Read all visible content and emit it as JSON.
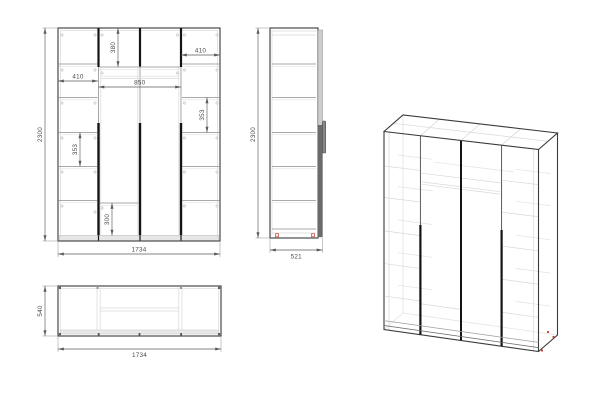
{
  "page": {
    "background": "#ffffff",
    "description": "wardrobe technical drawing with front, side, top and isometric views"
  },
  "colors": {
    "outline": "#3a3a3a",
    "inner_light": "#d8d8d8",
    "inner_mid": "#a9a9a9",
    "divider_dark": "#141414",
    "door_gray": "#6b6b6b",
    "plinth_fill": "#e6e6e6",
    "dimension_line": "#5a5a5a",
    "dimension_text": "#4a4a4a",
    "accent_red": "#cf3a2b"
  },
  "views": {
    "front": {
      "name": "front view",
      "dims": {
        "overall_height": "2300",
        "overall_width": "1734",
        "top_section_height": "380",
        "right_top_width": "410",
        "left_section_width": "410",
        "middle_width": "850",
        "right_shelf_spacing": "353",
        "left_shelf_spacing": "353",
        "bottom_section_height": "300"
      }
    },
    "side": {
      "name": "side view",
      "dims": {
        "overall_height": "2300",
        "overall_depth": "521"
      }
    },
    "top": {
      "name": "top view",
      "dims": {
        "overall_depth": "540",
        "overall_width": "1734"
      }
    },
    "iso": {
      "name": "isometric view"
    }
  }
}
